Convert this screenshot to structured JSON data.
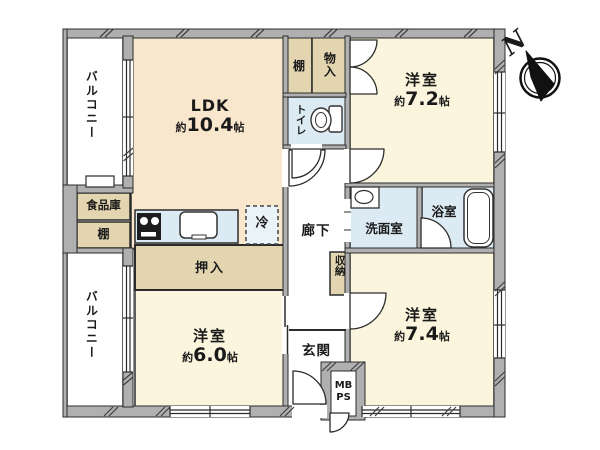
{
  "plan": {
    "north_label": "N",
    "rooms": {
      "balcony_top": {
        "label": "バルコニー"
      },
      "balcony_bottom": {
        "label": "バルコニー"
      },
      "ldk": {
        "name": "LDK",
        "area_prefix": "約",
        "area_value": "10.4",
        "area_unit": "帖"
      },
      "western_room_7_2": {
        "name": "洋室",
        "area_prefix": "約",
        "area_value": "7.2",
        "area_unit": "帖"
      },
      "western_room_7_4": {
        "name": "洋室",
        "area_prefix": "約",
        "area_value": "7.4",
        "area_unit": "帖"
      },
      "western_room_6_0": {
        "name": "洋室",
        "area_prefix": "約",
        "area_value": "6.0",
        "area_unit": "帖"
      },
      "pantry": {
        "label": "食品庫"
      },
      "shelf_left": {
        "label": "棚"
      },
      "shelf_top": {
        "label": "棚"
      },
      "closet_top": {
        "label": "物入"
      },
      "toilet": {
        "label": "トイレ"
      },
      "hallway": {
        "label": "廊下"
      },
      "washroom": {
        "label": "洗面室"
      },
      "bathroom": {
        "label": "浴室"
      },
      "hall_storage": {
        "label": "収納"
      },
      "oshiire": {
        "label": "押入"
      },
      "entrance": {
        "label": "玄関"
      },
      "refrigerator": {
        "label": "冷"
      },
      "meter_box": {
        "line1": "MB",
        "line2": "PS"
      }
    },
    "colors": {
      "wall": "#b0b0b0",
      "outline": "#2b2b2b",
      "ldk_floor": "#f9e7cd",
      "room_floor": "#fcf5dd",
      "storage_fill": "#e2d5b0",
      "wet_area_fill": "#dcebf3",
      "floor_white": "#ffffff"
    }
  }
}
